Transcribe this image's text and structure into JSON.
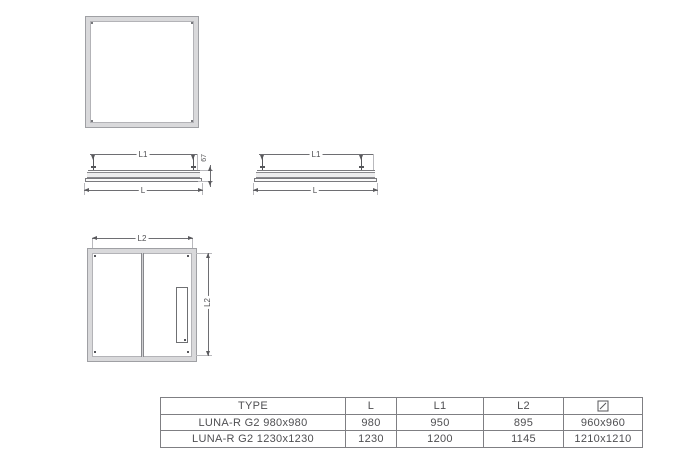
{
  "colors": {
    "background": "#ffffff",
    "frame_fill": "#d9d9db",
    "frame_edge": "#9fa0a4",
    "drawing_line": "#55565a",
    "dimension_line": "#6e6e72",
    "table_border": "#7f7f83",
    "text": "#4f4f52"
  },
  "dimensions": {
    "profile_left": {
      "top": "L1",
      "bottom": "L",
      "height": "67"
    },
    "profile_right": {
      "top": "L1",
      "bottom": "L"
    },
    "back_view": {
      "top": "L2",
      "right": "L2"
    }
  },
  "icons": {
    "cutout_symbol": "square-diagonal-icon"
  },
  "table": {
    "headers": {
      "type": "TYPE",
      "l": "L",
      "l1": "L1",
      "l2": "L2"
    },
    "rows": [
      {
        "type": "LUNA-R G2 980x980",
        "l": "980",
        "l1": "950",
        "l2": "895",
        "cutout": "960x960"
      },
      {
        "type": "LUNA-R G2 1230x1230",
        "l": "1230",
        "l1": "1200",
        "l2": "1145",
        "cutout": "1210x1210"
      }
    ]
  }
}
